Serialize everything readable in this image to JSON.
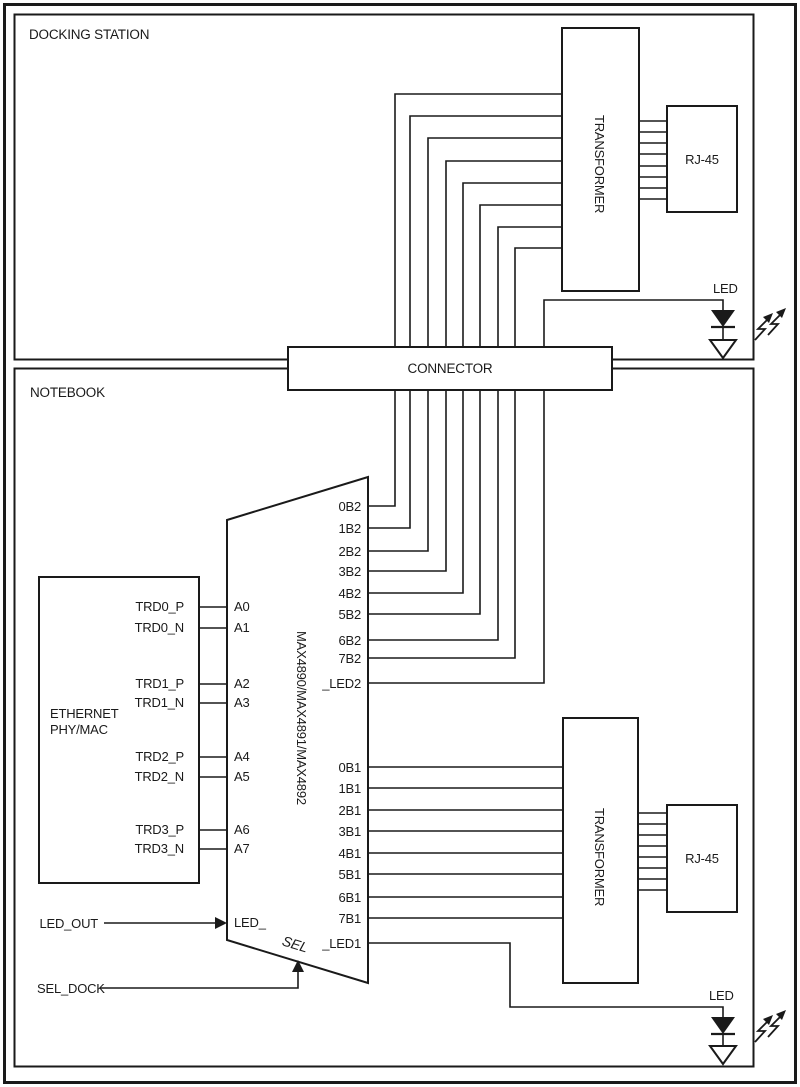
{
  "page": {
    "line_color": "#1a1a1a",
    "background": "#ffffff"
  },
  "docking": {
    "label": "DOCKING STATION",
    "transformer_label": "TRANSFORMER",
    "rj45_label": "RJ-45",
    "led_label": "LED"
  },
  "connector": {
    "label": "CONNECTOR"
  },
  "notebook": {
    "label": "NOTEBOOK",
    "transformer_label": "TRANSFORMER",
    "rj45_label": "RJ-45",
    "led_label": "LED",
    "phy": {
      "title_line1": "ETHERNET",
      "title_line2": "PHY/MAC",
      "pins": [
        "TRD0_P",
        "TRD0_N",
        "TRD1_P",
        "TRD1_N",
        "TRD2_P",
        "TRD2_N",
        "TRD3_P",
        "TRD3_N"
      ]
    },
    "chip": {
      "label": "MAX4890/MAX4891/MAX4892",
      "left_pins": [
        "A0",
        "A1",
        "A2",
        "A3",
        "A4",
        "A5",
        "A6",
        "A7"
      ],
      "led_pin": "LED_",
      "sel_pin": "SEL",
      "b2_pins": [
        "0B2",
        "1B2",
        "2B2",
        "3B2",
        "4B2",
        "5B2",
        "6B2",
        "7B2"
      ],
      "led2_pin": "_LED2",
      "b1_pins": [
        "0B1",
        "1B1",
        "2B1",
        "3B1",
        "4B1",
        "5B1",
        "6B1",
        "7B1"
      ],
      "led1_pin": "_LED1"
    },
    "signals": {
      "led_out": "LED_OUT",
      "sel_dock": "SEL_DOCK"
    }
  }
}
